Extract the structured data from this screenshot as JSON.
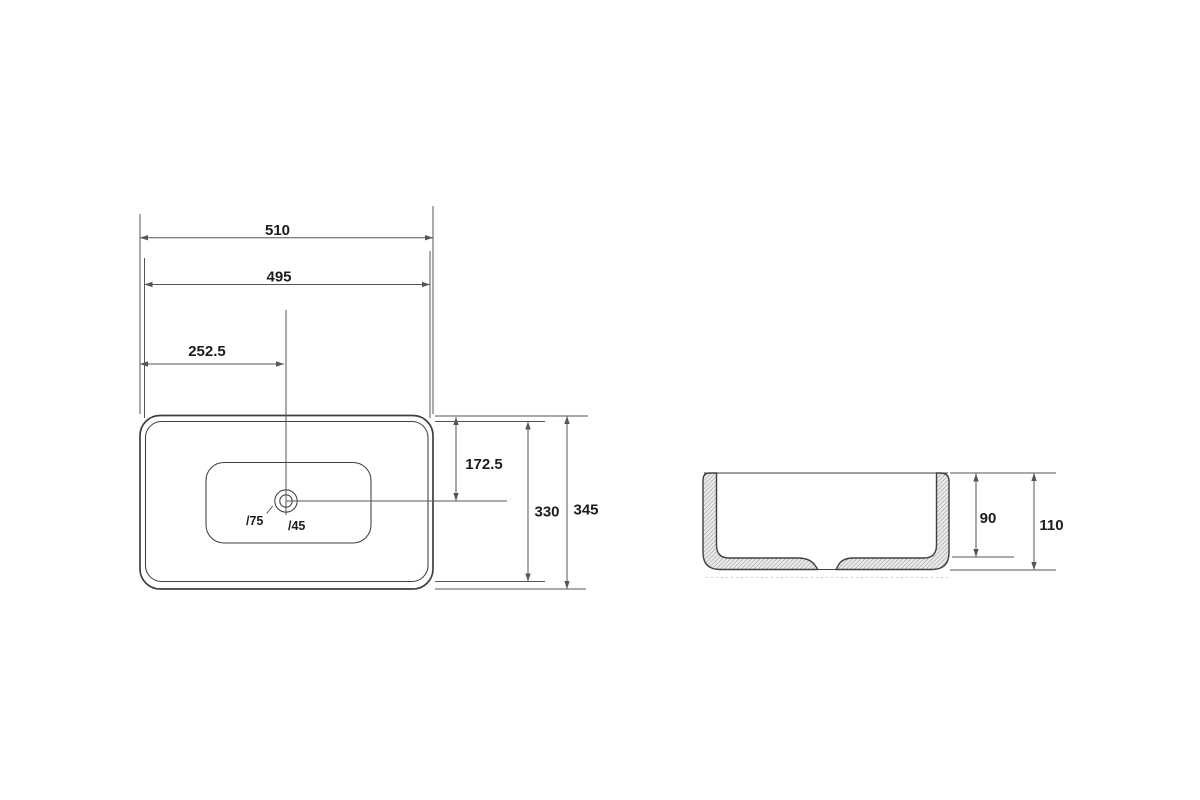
{
  "colors": {
    "background": "#ffffff",
    "outline": "#3f3f3f",
    "dimension": "#565656",
    "text": "#1c1c1c",
    "hatch_fill": "#ececec",
    "hatch_line": "#999999"
  },
  "top_view": {
    "dim_overall_width": "510",
    "dim_rim_width": "495",
    "dim_drain_offset_x": "252.5",
    "dim_drain_offset_y": "172.5",
    "dim_rim_depth": "330",
    "dim_overall_depth": "345",
    "label_drain_outer_diameter": "/75",
    "label_drain_inner_diameter": "/45"
  },
  "side_view": {
    "dim_inner_depth": "90",
    "dim_overall_height": "110"
  }
}
